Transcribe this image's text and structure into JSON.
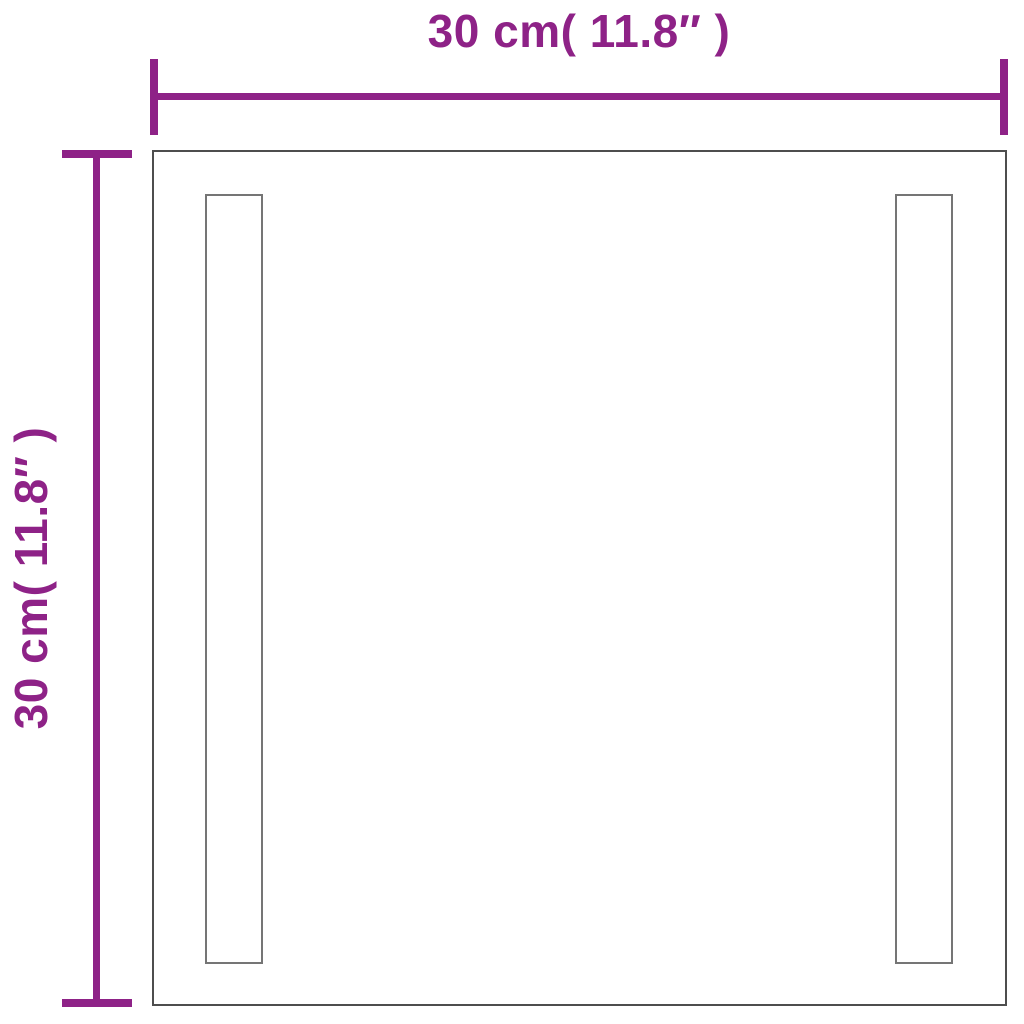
{
  "diagram": {
    "type": "product-dimension-diagram",
    "subject": "square-led-mirror",
    "background_color": "#ffffff",
    "horizontal_dimension": {
      "label": "30 cm( 11.8″ )",
      "value_cm": 30,
      "value_in": 11.8
    },
    "vertical_dimension": {
      "label": "30 cm( 11.8″ )",
      "value_cm": 30,
      "value_in": 11.8
    },
    "colors": {
      "dimension_accent": "#8e2287",
      "mirror_outline": "#4e4e4e",
      "led_strip_outline": "#757575"
    }
  }
}
